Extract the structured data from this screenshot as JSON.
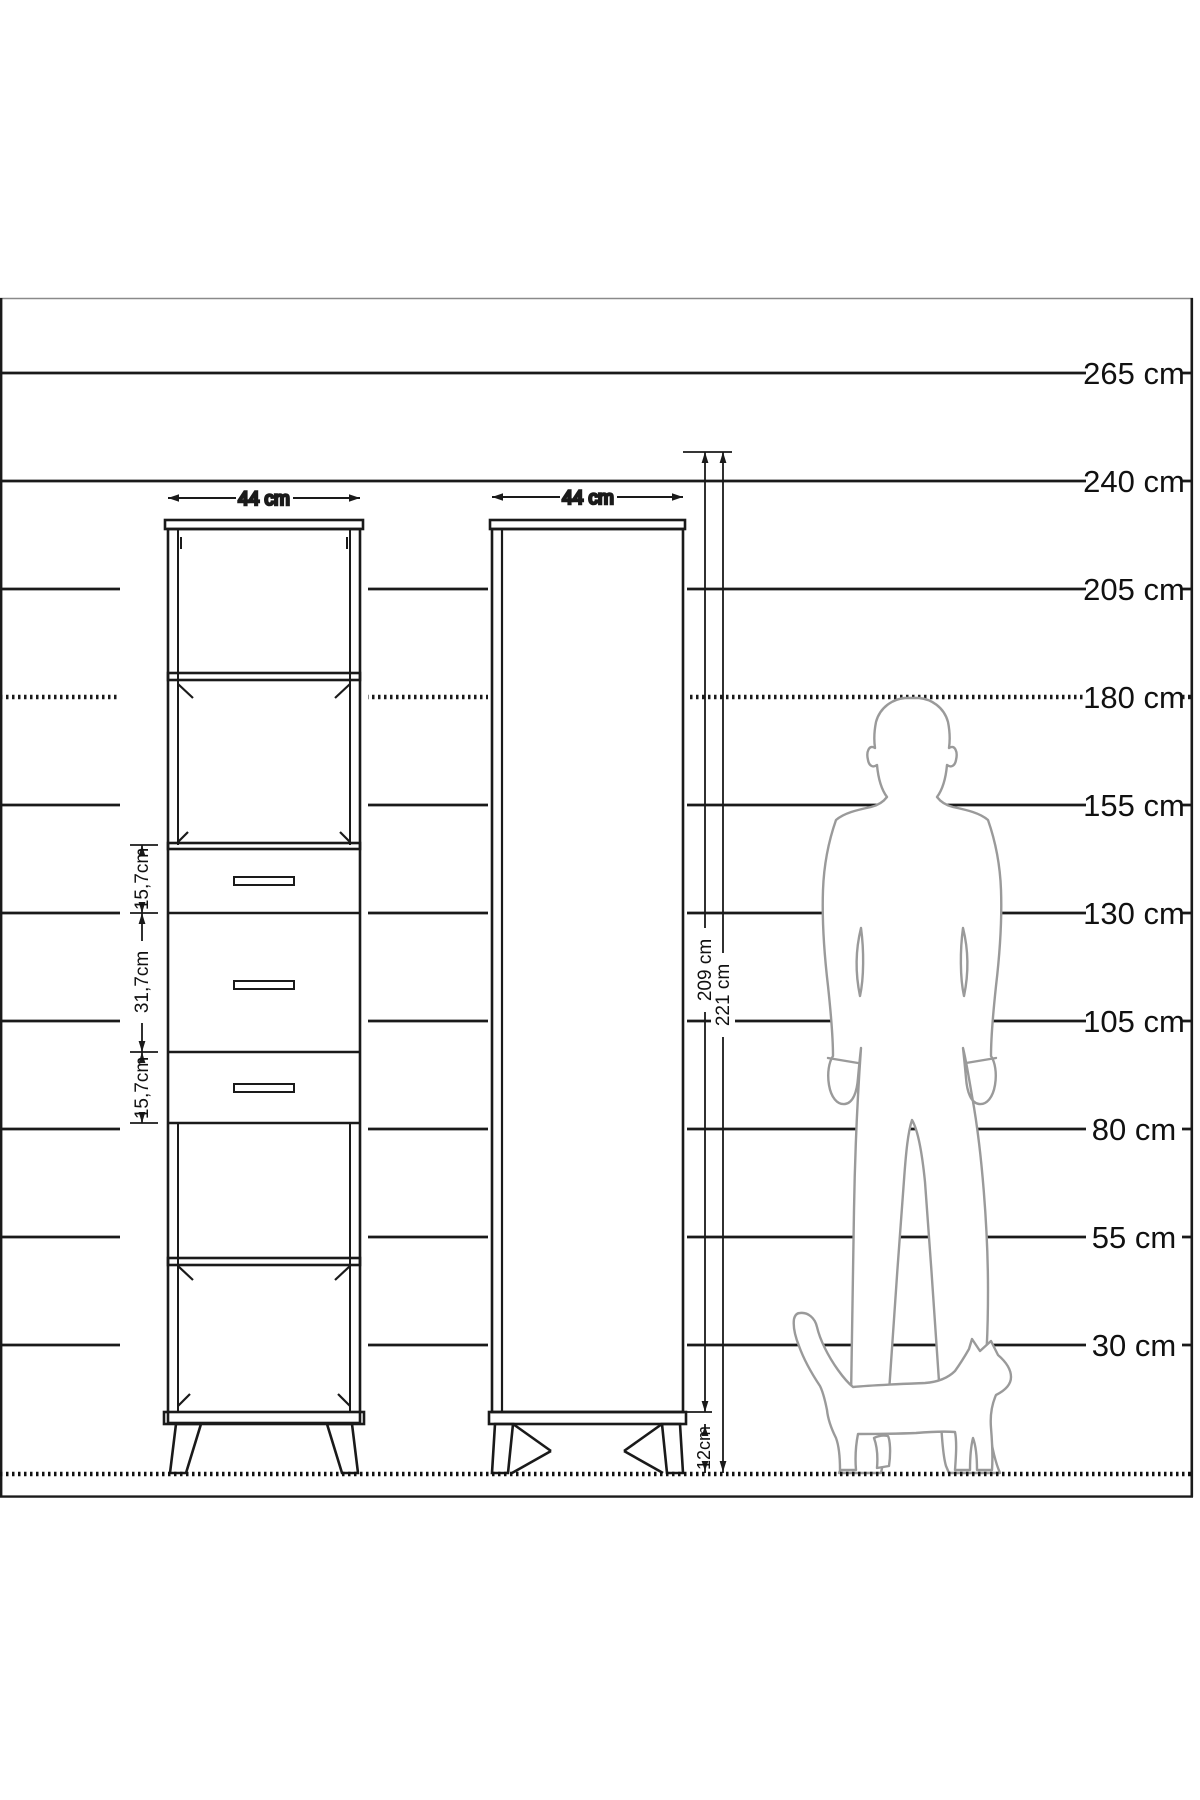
{
  "drawing": {
    "type": "furniture-scale-elevation",
    "colors": {
      "line": "#1a1a1a",
      "silhouette": "#9a9a9a",
      "background": "#ffffff"
    },
    "scale": {
      "unit": "cm",
      "items": [
        {
          "label": "265 cm",
          "value": 265
        },
        {
          "label": "240 cm",
          "value": 240
        },
        {
          "label": "205 cm",
          "value": 205
        },
        {
          "label": "180 cm",
          "value": 180,
          "style": "dotted"
        },
        {
          "label": "155 cm",
          "value": 155
        },
        {
          "label": "130 cm",
          "value": 130
        },
        {
          "label": "105 cm",
          "value": 105
        },
        {
          "label": "80 cm",
          "value": 80
        },
        {
          "label": "55 cm",
          "value": 55
        },
        {
          "label": "30 cm",
          "value": 30
        }
      ]
    },
    "left_cabinet": {
      "width_label": "44 cm",
      "drawer_dims": [
        "15,7cm",
        "31,7cm",
        "15,7cm"
      ]
    },
    "right_cabinet": {
      "width_label": "44 cm",
      "body_height_label": "209 cm",
      "total_height_label": "221 cm",
      "leg_height_label": "12cm"
    }
  }
}
